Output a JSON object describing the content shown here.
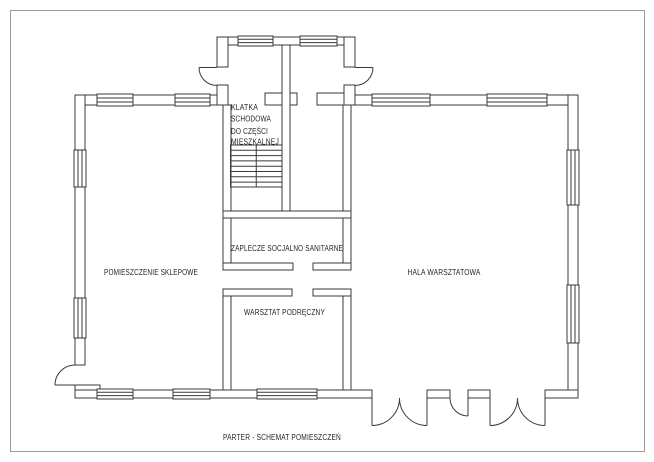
{
  "drawing": {
    "caption": "PARTER - SCHEMAT POMIESZCZEŃ",
    "rooms": {
      "shop": "POMIESZCZENIE SKLEPOWE",
      "hall": "HALA WARSZTATOWA",
      "social": "ZAPLECZE SOCJALNO SANITARNE",
      "aux_workshop": "WARSZTAT PODRĘCZNY",
      "staircase_line1": "KLATKA",
      "staircase_line2": "SCHODOWA",
      "staircase_line3": "DO CZĘŚCI",
      "staircase_line4": "MIESZKALNEJ"
    }
  },
  "colors": {
    "wall_line": "#3a3a3a",
    "frame": "#9a9a9a",
    "text": "#1f1f1f",
    "background": "#ffffff"
  }
}
